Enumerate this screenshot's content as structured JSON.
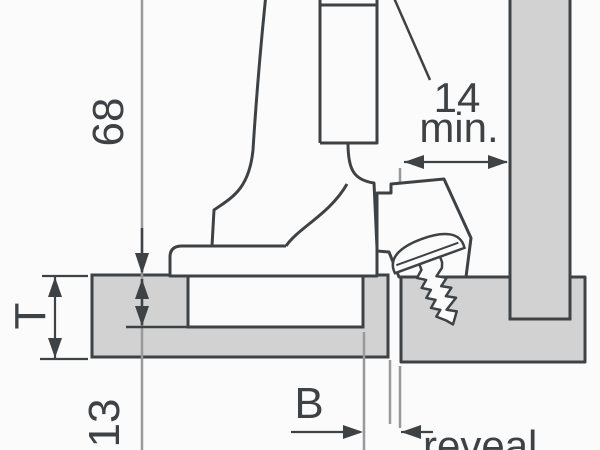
{
  "diagram": {
    "title": "hinge-mounting-cross-section",
    "labels": {
      "height": "68",
      "door_thickness": "T",
      "drilling_depth": "13",
      "boring_distance": "B",
      "reveal": "reveal",
      "min_clearance_value": "14",
      "min_clearance_unit": "min."
    },
    "colors": {
      "panel_fill": "#d2d2d2",
      "outline": "#3f4245",
      "dimension": "#3f4245",
      "reference_line": "#97999b",
      "background": "#fbfbfb"
    }
  }
}
